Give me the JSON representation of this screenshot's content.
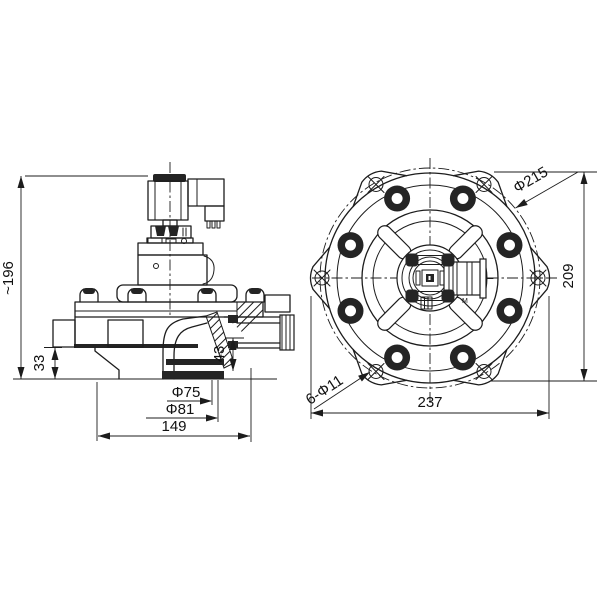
{
  "colors": {
    "ink": "#1c1c1c",
    "paper": "#ffffff"
  },
  "side_view": {
    "dims": {
      "overall_height": "~196",
      "inlet_height": "33",
      "outlet_step": "43",
      "outlet_bore": "Φ75",
      "outlet_od": "Φ81",
      "base_width": "149"
    }
  },
  "front_view": {
    "dims": {
      "bolt_circle_dia": "Φ215",
      "overall_height": "209",
      "overall_width": "237",
      "mounting_holes": "6-Φ11"
    },
    "coil_mark": "M"
  }
}
